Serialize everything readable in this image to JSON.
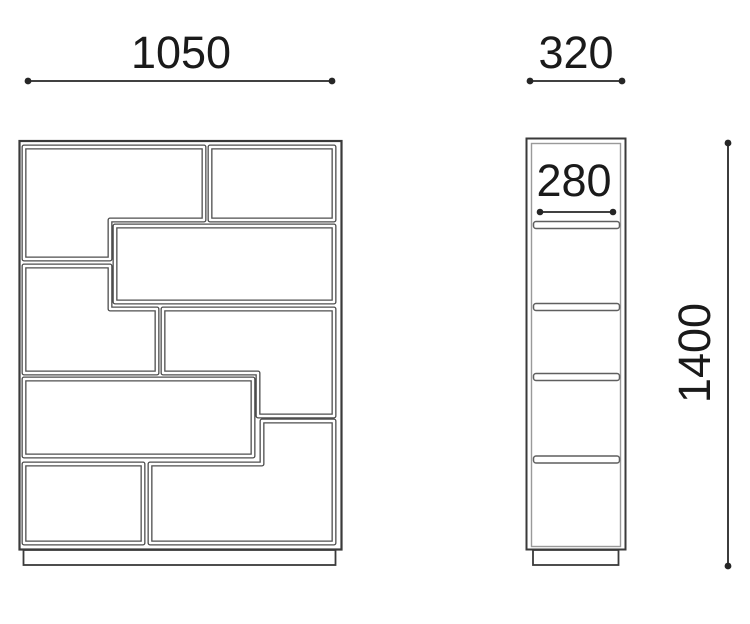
{
  "diagram": {
    "front_view": {
      "width_dim": "1050"
    },
    "side_view": {
      "outer_depth_dim": "320",
      "shelf_depth_dim": "280",
      "height_dim": "1400"
    },
    "colors": {
      "outline": "#3a3a3a",
      "compartment_line": "#4d4d4d",
      "slab_line": "#5f5f5f",
      "inner_wall_line": "#9a9a9a",
      "dimension_line": "#262626",
      "dimension_text": "#1a1a1a",
      "background": "#ffffff"
    }
  }
}
